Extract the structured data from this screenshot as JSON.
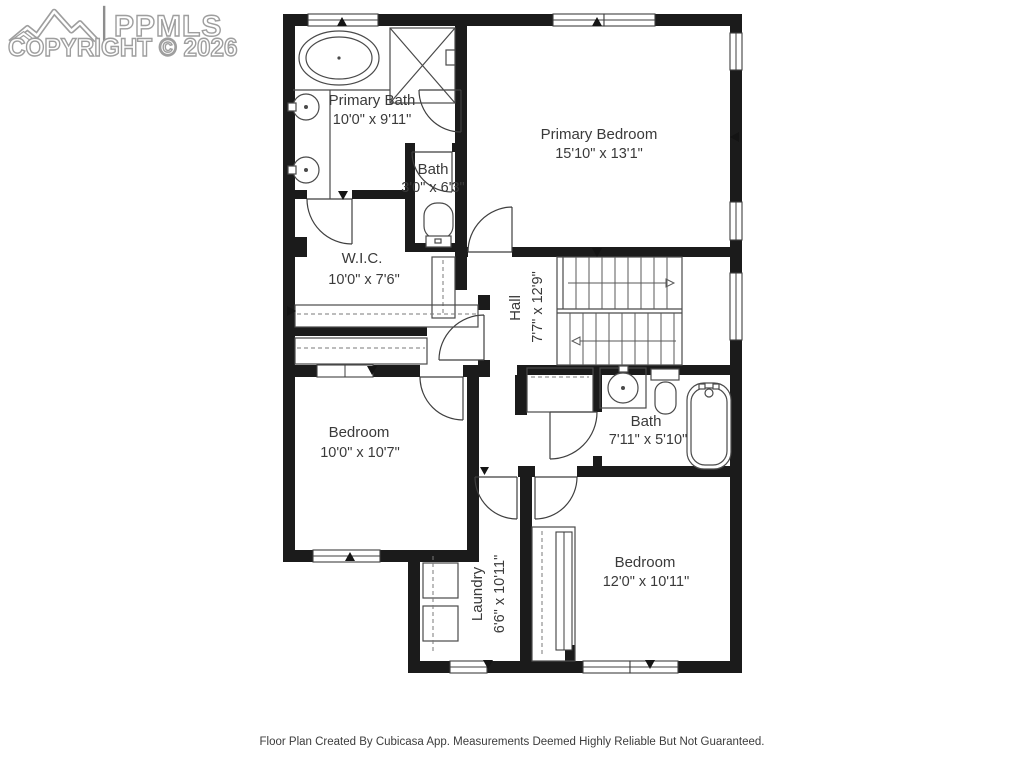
{
  "watermark": {
    "brand": "PPMLS",
    "copyright": "COPYRIGHT © 2026"
  },
  "rooms": {
    "primary_bath": {
      "name": "Primary Bath",
      "dim": "10'0\" x 9'11\""
    },
    "bath_upper": {
      "name": "Bath",
      "dim": "3'0\" x 6'3\""
    },
    "primary_bedroom": {
      "name": "Primary Bedroom",
      "dim": "15'10\" x 13'1\""
    },
    "wic": {
      "name": "W.I.C.",
      "dim": "10'0\" x 7'6\""
    },
    "hall": {
      "name": "Hall",
      "dim": "7'7\" x 12'9\""
    },
    "bedroom_left": {
      "name": "Bedroom",
      "dim": "10'0\" x 10'7\""
    },
    "bath_middle": {
      "name": "Bath",
      "dim": "7'11\" x 5'10\""
    },
    "laundry": {
      "name": "Laundry",
      "dim": "6'6\" x 10'11\""
    },
    "bedroom_right": {
      "name": "Bedroom",
      "dim": "12'0\" x 10'11\""
    }
  },
  "footer": {
    "disclaimer": "Floor Plan Created By Cubicasa App. Measurements Deemed Highly Reliable But Not Guaranteed."
  },
  "colors": {
    "wall": "#1b1b1b",
    "line": "#4a4a4a",
    "label": "#3a3a3a",
    "watermark_outline": "#9e9e9e",
    "background": "#ffffff"
  }
}
